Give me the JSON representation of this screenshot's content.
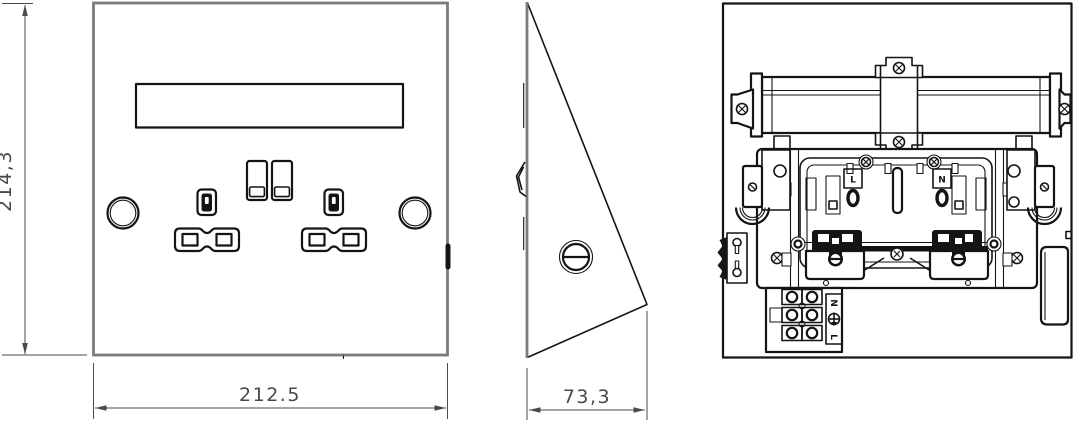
{
  "colors": {
    "line": "#141414",
    "panel_outline_gray": "#7b7b7b",
    "dimension_gray": "#4a4a4a",
    "background": "#ffffff"
  },
  "front_view": {
    "height_dim": "214,3",
    "width_dim": "212.5"
  },
  "side_view": {
    "depth_dim": "73,3"
  },
  "back_view": {
    "live_label": "L",
    "neutral_label": "N",
    "terminal_block": {
      "top_label": "N",
      "bottom_label": "L"
    }
  }
}
